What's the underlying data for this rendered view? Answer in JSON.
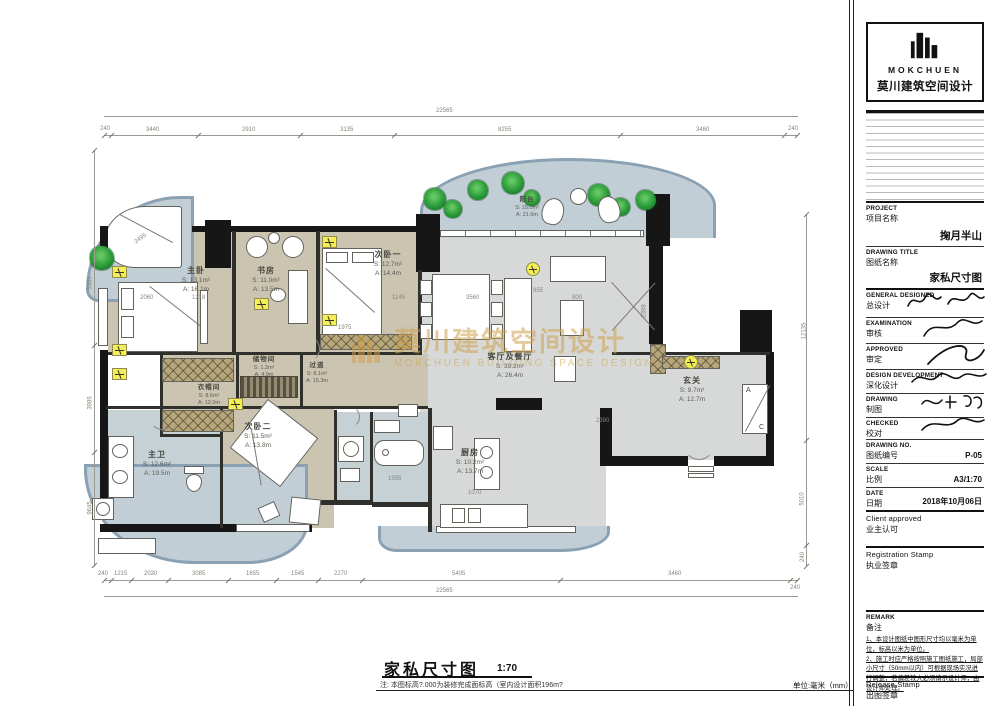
{
  "page": {
    "title": "家私尺寸图",
    "scale": "1:70",
    "footnote": "注: 本图标高?.000为装修完成面标高（室内设计面积196m?",
    "unit": "单位:毫米（mm）"
  },
  "watermark": {
    "cn": "莫川建筑空间设计",
    "en": "MOKCHUEN BUILDING SPACE DESIGN"
  },
  "rooms": [
    {
      "name": "主卧",
      "s": "S: 13.1m²",
      "a": "A: 16.1m"
    },
    {
      "name": "书房",
      "s": "S: 11.0m²",
      "a": "A: 13.5m"
    },
    {
      "name": "次卧一",
      "s": "S: 12.7m²",
      "a": "A: 14.4m"
    },
    {
      "name": "阳台",
      "s": "S: 15.0m²",
      "a": "A: 21.6m"
    },
    {
      "name": "客厅及餐厅",
      "s": "S: 39.2m²",
      "a": "A: 26.4m"
    },
    {
      "name": "玄关",
      "s": "S: 9.7m²",
      "a": "A: 12.7m"
    },
    {
      "name": "储物间",
      "s": "S: 1.3m²",
      "a": "A: 4.9m"
    },
    {
      "name": "过道",
      "s": "S: 8.1m²",
      "a": "A: 15.3m"
    },
    {
      "name": "衣帽间",
      "s": "S: 8.6m²",
      "a": "A: 12.0m"
    },
    {
      "name": "主卫",
      "s": "S: 12.6m²",
      "a": "A: 19.5m"
    },
    {
      "name": "次卧二",
      "s": "S: 11.5m²",
      "a": "A: 13.8m"
    },
    {
      "name": "厨房",
      "s": "S: 10.2m²",
      "a": "A: 13.7m"
    }
  ],
  "dims": {
    "top_overall": "22565",
    "top_segs": [
      "240",
      "3440",
      "2910",
      "3135",
      "8255",
      "3460",
      "240"
    ],
    "bottom_segs": [
      "240",
      "1215",
      "2030",
      "3085",
      "1655",
      "1545",
      "2270",
      "5405",
      "3460",
      "240"
    ],
    "bottom_overall": "22565",
    "left_segs": [
      "5385",
      "3985",
      "9645"
    ],
    "right_segs": [
      "12135",
      "5010",
      "240"
    ],
    "interior": [
      "2495",
      "2060",
      "1218",
      "1975",
      "1145",
      "3560",
      "955",
      "800",
      "2390",
      "2398",
      "1595",
      "1070"
    ]
  },
  "plan": {
    "ac": {
      "a": "A",
      "c": "C"
    }
  },
  "titleblock": {
    "brand": "MOKCHUEN",
    "brand_cn": "莫川建筑空间设计",
    "project": {
      "en": "PROJECT",
      "cn": "项目名称",
      "value": "掬月半山"
    },
    "drawing_title": {
      "en": "DRAWING TITLE",
      "cn": "图纸名称",
      "value": "家私尺寸图"
    },
    "sign_rows": [
      {
        "en": "GENERAL DESIGNED",
        "cn": "总设计"
      },
      {
        "en": "EXAMINATION",
        "cn": "审核"
      },
      {
        "en": "APPROVED",
        "cn": "审定"
      },
      {
        "en": "DESIGN DEVELOPMENT",
        "cn": "深化设计"
      },
      {
        "en": "DRAWING",
        "cn": "制图"
      },
      {
        "en": "CHECKED",
        "cn": "校对"
      }
    ],
    "drawing_no": {
      "en": "DRAWING NO.",
      "cn": "图纸编号",
      "value": "P-05"
    },
    "scale": {
      "en": "SCALE",
      "cn": "比例",
      "value": "A3/1:70"
    },
    "date": {
      "en": "DATE",
      "cn": "日期",
      "value": "2018年10月06日"
    },
    "client": {
      "en": "Client approved",
      "cn": "业主认可"
    },
    "registration": {
      "en": "Registration Stamp",
      "cn": "执业签章"
    },
    "remark": {
      "en": "REMARK",
      "cn": "备注",
      "note1": "1、本设计图纸中图形尺寸均以毫米为单位，标高以米为单位。",
      "note2": "2、施工时应严格按照施工图纸施工，局部小尺寸（50mm以内）可根据现场实况进行调整，若偏差较大必须请示设计师，由设计师处理。"
    },
    "release": {
      "en": "Release Stamp",
      "cn": "出图签章"
    }
  }
}
